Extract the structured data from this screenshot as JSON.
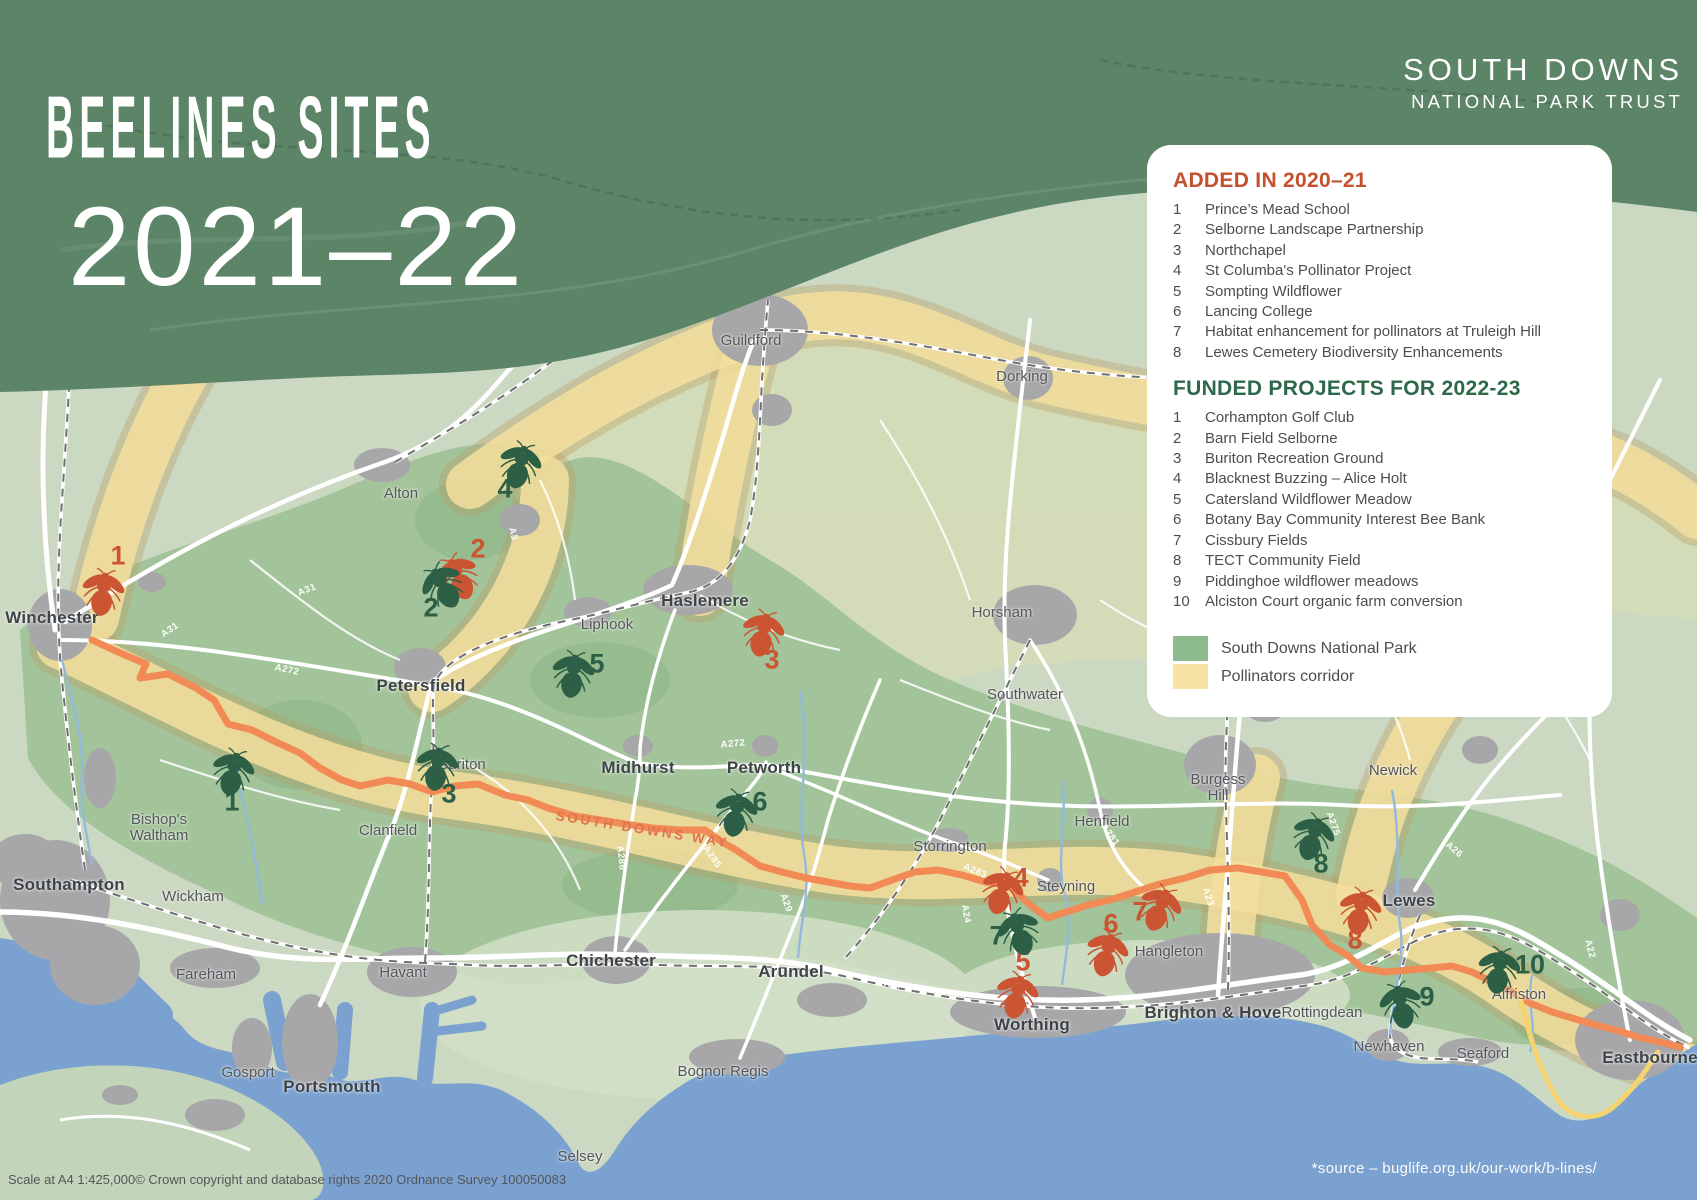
{
  "title": {
    "line1": "BEELINES SITES",
    "line2": "2021–22"
  },
  "brand": {
    "line1": "SOUTH DOWNS",
    "line2": "NATIONAL PARK TRUST"
  },
  "panel": {
    "sections": [
      {
        "id": "added",
        "heading": "ADDED IN 2020–21",
        "heading_color": "#c5502d",
        "items": [
          "Prince’s Mead School",
          "Selborne Landscape Partnership",
          "Northchapel",
          "St Columba's Pollinator Project",
          "Sompting Wildflower",
          "Lancing College",
          "Habitat enhancement for pollinators at Truleigh Hill",
          "Lewes Cemetery Biodiversity Enhancements"
        ]
      },
      {
        "id": "funded",
        "heading": "FUNDED PROJECTS FOR 2022-23",
        "heading_color": "#2e684a",
        "items": [
          "Corhampton Golf Club",
          "Barn Field Selborne",
          "Buriton Recreation Ground",
          "Blacknest Buzzing – Alice Holt",
          "Catersland Wildflower Meadow",
          "Botany Bay Community Interest Bee Bank",
          "Cissbury Fields",
          "TECT Community Field",
          "Piddinghoe wildflower meadows",
          "Alciston Court organic farm conversion"
        ]
      }
    ],
    "legend": [
      {
        "label": "South Downs National Park",
        "color": "#8dbb8d"
      },
      {
        "label": "Pollinators corridor",
        "color": "#f9e2a6"
      }
    ]
  },
  "map": {
    "trail_label": "SOUTH DOWNS WAY",
    "towns": [
      {
        "n": "Winchester",
        "x": 52,
        "y": 618,
        "c": "major"
      },
      {
        "n": "Southampton",
        "x": 69,
        "y": 885,
        "c": "major"
      },
      {
        "n": "Portsmouth",
        "x": 332,
        "y": 1087,
        "c": "major"
      },
      {
        "n": "Petersfield",
        "x": 421,
        "y": 686,
        "c": "major"
      },
      {
        "n": "Chichester",
        "x": 611,
        "y": 961,
        "c": "major"
      },
      {
        "n": "Haslemere",
        "x": 705,
        "y": 601,
        "c": "major"
      },
      {
        "n": "Midhurst",
        "x": 638,
        "y": 768,
        "c": "major"
      },
      {
        "n": "Petworth",
        "x": 764,
        "y": 768,
        "c": "major"
      },
      {
        "n": "Arundel",
        "x": 791,
        "y": 972,
        "c": "major"
      },
      {
        "n": "Worthing",
        "x": 1032,
        "y": 1025,
        "c": "major"
      },
      {
        "n": "Brighton & Hove",
        "x": 1213,
        "y": 1013,
        "c": "major"
      },
      {
        "n": "Lewes",
        "x": 1409,
        "y": 901,
        "c": "major"
      },
      {
        "n": "Eastbourne",
        "x": 1650,
        "y": 1058,
        "c": "major"
      },
      {
        "n": "Alton",
        "x": 401,
        "y": 494,
        "c": "minor"
      },
      {
        "n": "Liphook",
        "x": 607,
        "y": 625,
        "c": "minor"
      },
      {
        "n": "Guildford",
        "x": 751,
        "y": 341,
        "c": "minor"
      },
      {
        "n": "Dorking",
        "x": 1022,
        "y": 377,
        "c": "minor"
      },
      {
        "n": "Horsham",
        "x": 1002,
        "y": 613,
        "c": "minor"
      },
      {
        "n": "Southwater",
        "x": 1025,
        "y": 695,
        "c": "minor"
      },
      {
        "n": "Bishop's\nWaltham",
        "x": 159,
        "y": 828,
        "c": "minor"
      },
      {
        "n": "Clanfield",
        "x": 388,
        "y": 831,
        "c": "minor"
      },
      {
        "n": "Buriton",
        "x": 462,
        "y": 765,
        "c": "minor"
      },
      {
        "n": "Wickham",
        "x": 193,
        "y": 897,
        "c": "minor"
      },
      {
        "n": "Fareham",
        "x": 206,
        "y": 975,
        "c": "minor"
      },
      {
        "n": "Havant",
        "x": 403,
        "y": 973,
        "c": "minor"
      },
      {
        "n": "Gosport",
        "x": 248,
        "y": 1073,
        "c": "minor"
      },
      {
        "n": "Bognor Regis",
        "x": 723,
        "y": 1072,
        "c": "minor"
      },
      {
        "n": "Selsey",
        "x": 580,
        "y": 1157,
        "c": "minor"
      },
      {
        "n": "Storrington",
        "x": 950,
        "y": 847,
        "c": "minor"
      },
      {
        "n": "Steyning",
        "x": 1066,
        "y": 887,
        "c": "minor"
      },
      {
        "n": "Henfield",
        "x": 1102,
        "y": 822,
        "c": "minor"
      },
      {
        "n": "Hangleton",
        "x": 1169,
        "y": 952,
        "c": "minor"
      },
      {
        "n": "Burgess\nHill",
        "x": 1218,
        "y": 788,
        "c": "minor"
      },
      {
        "n": "Newick",
        "x": 1393,
        "y": 771,
        "c": "minor"
      },
      {
        "n": "Rottingdean",
        "x": 1322,
        "y": 1013,
        "c": "minor"
      },
      {
        "n": "Newhaven",
        "x": 1389,
        "y": 1047,
        "c": "minor"
      },
      {
        "n": "Seaford",
        "x": 1483,
        "y": 1054,
        "c": "minor"
      },
      {
        "n": "Alfriston",
        "x": 1519,
        "y": 995,
        "c": "minor"
      }
    ],
    "road_labels": [
      {
        "t": "A31",
        "x": 170,
        "y": 630,
        "r": -35
      },
      {
        "t": "A31",
        "x": 307,
        "y": 590,
        "r": -22
      },
      {
        "t": "A272",
        "x": 287,
        "y": 670,
        "r": 12
      },
      {
        "t": "A272",
        "x": 733,
        "y": 744,
        "r": -5
      },
      {
        "t": "A3",
        "x": 513,
        "y": 534,
        "r": 78
      },
      {
        "t": "A286",
        "x": 621,
        "y": 858,
        "r": 85
      },
      {
        "t": "A285",
        "x": 712,
        "y": 857,
        "r": 55
      },
      {
        "t": "A283",
        "x": 975,
        "y": 871,
        "r": 22
      },
      {
        "t": "A24",
        "x": 966,
        "y": 914,
        "r": 80
      },
      {
        "t": "A29",
        "x": 786,
        "y": 903,
        "r": 70
      },
      {
        "t": "A281",
        "x": 1110,
        "y": 835,
        "r": 55
      },
      {
        "t": "A23",
        "x": 1208,
        "y": 897,
        "r": 72
      },
      {
        "t": "A27",
        "x": 893,
        "y": 985,
        "r": 8
      },
      {
        "t": "A275",
        "x": 1333,
        "y": 824,
        "r": 70
      },
      {
        "t": "A26",
        "x": 1454,
        "y": 850,
        "r": 40
      },
      {
        "t": "A22",
        "x": 1590,
        "y": 949,
        "r": 75
      }
    ],
    "markers": {
      "added": [
        {
          "n": "1",
          "x": 103,
          "y": 592,
          "r": 8,
          "nx": 118,
          "ny": 556
        },
        {
          "n": "2",
          "x": 458,
          "y": 577,
          "r": -25,
          "nx": 478,
          "ny": 549
        },
        {
          "n": "3",
          "x": 763,
          "y": 633,
          "r": 12,
          "nx": 772,
          "ny": 660
        },
        {
          "n": "4",
          "x": 1002,
          "y": 891,
          "r": 18,
          "nx": 1021,
          "ny": 878
        },
        {
          "n": "5",
          "x": 1017,
          "y": 995,
          "r": 12,
          "nx": 1023,
          "ny": 962
        },
        {
          "n": "6",
          "x": 1107,
          "y": 953,
          "r": 15,
          "nx": 1111,
          "ny": 924
        },
        {
          "n": "7",
          "x": 1160,
          "y": 908,
          "r": 22,
          "nx": 1140,
          "ny": 912
        },
        {
          "n": "8",
          "x": 1360,
          "y": 911,
          "r": 10,
          "nx": 1355,
          "ny": 940
        }
      ],
      "funded": [
        {
          "n": "1",
          "x": 233,
          "y": 772,
          "r": 12,
          "nx": 232,
          "ny": 802
        },
        {
          "n": "2",
          "x": 443,
          "y": 586,
          "r": -30,
          "nx": 431,
          "ny": 608
        },
        {
          "n": "3",
          "x": 437,
          "y": 767,
          "r": 8,
          "nx": 449,
          "ny": 794
        },
        {
          "n": "4",
          "x": 520,
          "y": 465,
          "r": 15,
          "nx": 505,
          "ny": 489
        },
        {
          "n": "5",
          "x": 573,
          "y": 674,
          "r": 8,
          "nx": 597,
          "ny": 664
        },
        {
          "n": "6",
          "x": 736,
          "y": 813,
          "r": 10,
          "nx": 760,
          "ny": 802
        },
        {
          "n": "7",
          "x": 1019,
          "y": 932,
          "r": -18,
          "nx": 997,
          "ny": 936
        },
        {
          "n": "8",
          "x": 1313,
          "y": 837,
          "r": 18,
          "nx": 1321,
          "ny": 864
        },
        {
          "n": "9",
          "x": 1401,
          "y": 1005,
          "r": -12,
          "nx": 1427,
          "ny": 997
        },
        {
          "n": "10",
          "x": 1499,
          "y": 970,
          "r": 8,
          "nx": 1530,
          "ny": 965
        }
      ]
    }
  },
  "footer": {
    "scale_text": "Scale at A4 1:425,000© Crown copyright and database rights 2020 Ordnance Survey 100050083",
    "source_text": "*source – buglife.org.uk/our-work/b-lines/"
  },
  "colors": {
    "added": "#cb5433",
    "funded": "#2c5f45",
    "header_band": "#5c8466"
  }
}
